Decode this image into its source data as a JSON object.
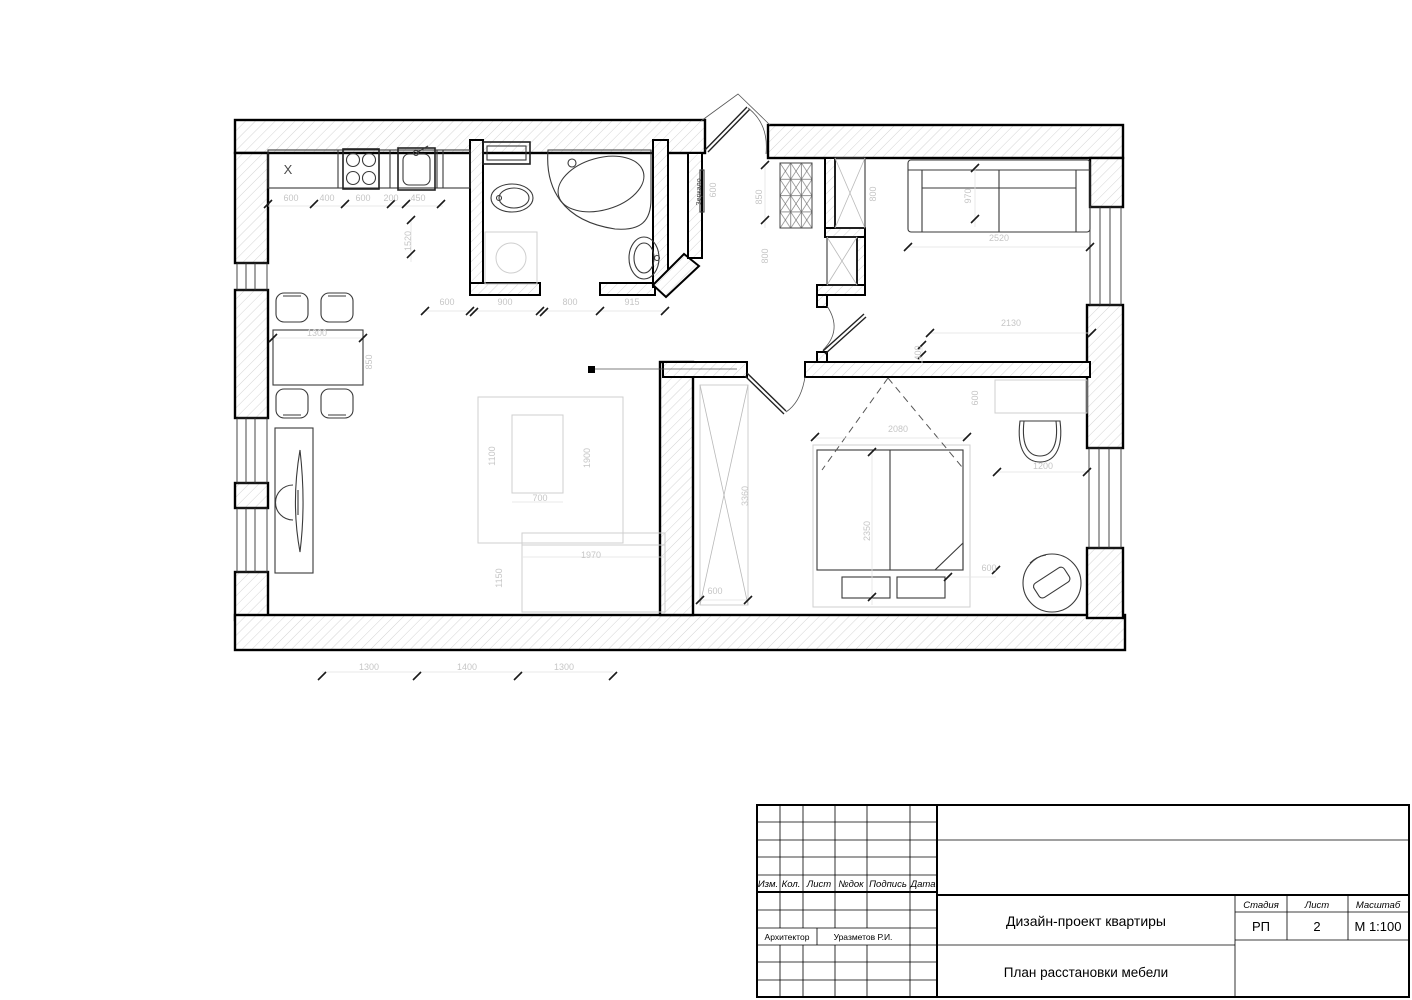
{
  "sheet": {
    "plan_labels": {
      "mirror": "Зеркало",
      "kitchen_mark": "X"
    },
    "dimensions": [
      {
        "t": "600",
        "x": 291,
        "y": 201
      },
      {
        "t": "400",
        "x": 327,
        "y": 201
      },
      {
        "t": "600",
        "x": 363,
        "y": 201
      },
      {
        "t": "200",
        "x": 391,
        "y": 201
      },
      {
        "t": "450",
        "x": 418,
        "y": 201
      },
      {
        "t": "1520",
        "x": 411,
        "y": 241,
        "r": -90
      },
      {
        "t": "600",
        "x": 447,
        "y": 305
      },
      {
        "t": "900",
        "x": 505,
        "y": 305
      },
      {
        "t": "800",
        "x": 570,
        "y": 305
      },
      {
        "t": "915",
        "x": 632,
        "y": 305
      },
      {
        "t": "600",
        "x": 716,
        "y": 190,
        "r": -90
      },
      {
        "t": "850",
        "x": 762,
        "y": 197,
        "r": -90
      },
      {
        "t": "800",
        "x": 768,
        "y": 256,
        "r": -90
      },
      {
        "t": "800",
        "x": 876,
        "y": 194,
        "r": -90
      },
      {
        "t": "970",
        "x": 971,
        "y": 196,
        "r": -90
      },
      {
        "t": "2520",
        "x": 999,
        "y": 241
      },
      {
        "t": "2130",
        "x": 1011,
        "y": 326
      },
      {
        "t": "400",
        "x": 921,
        "y": 353,
        "r": -90
      },
      {
        "t": "2080",
        "x": 898,
        "y": 432
      },
      {
        "t": "2350",
        "x": 870,
        "y": 531,
        "r": -90
      },
      {
        "t": "3360",
        "x": 748,
        "y": 496,
        "r": -90
      },
      {
        "t": "600",
        "x": 715,
        "y": 594
      },
      {
        "t": "600",
        "x": 978,
        "y": 398,
        "r": -90
      },
      {
        "t": "1200",
        "x": 1043,
        "y": 469
      },
      {
        "t": "600",
        "x": 989,
        "y": 571
      },
      {
        "t": "1300",
        "x": 317,
        "y": 336
      },
      {
        "t": "850",
        "x": 372,
        "y": 362,
        "r": -90
      },
      {
        "t": "1100",
        "x": 495,
        "y": 456,
        "r": -90
      },
      {
        "t": "700",
        "x": 540,
        "y": 501
      },
      {
        "t": "1900",
        "x": 590,
        "y": 458,
        "r": -90
      },
      {
        "t": "1970",
        "x": 591,
        "y": 558
      },
      {
        "t": "1150",
        "x": 502,
        "y": 578,
        "r": -90
      },
      {
        "t": "1300",
        "x": 369,
        "y": 670
      },
      {
        "t": "1400",
        "x": 467,
        "y": 670
      },
      {
        "t": "1300",
        "x": 564,
        "y": 670
      }
    ]
  },
  "title_block": {
    "revision_headers": [
      "Изм.",
      "Кол.",
      "Лист",
      "№док",
      "Подпись",
      "Дата"
    ],
    "architect_label": "Архитектор",
    "architect_name": "Уразметов Р.И.",
    "project_title": "Дизайн-проект квартиры",
    "sheet_title": "План расстановки мебели",
    "stage_label": "Стадия",
    "stage_value": "РП",
    "sheet_label": "Лист",
    "sheet_number": "2",
    "scale_label": "Масштаб",
    "scale_value": "М 1:100"
  }
}
